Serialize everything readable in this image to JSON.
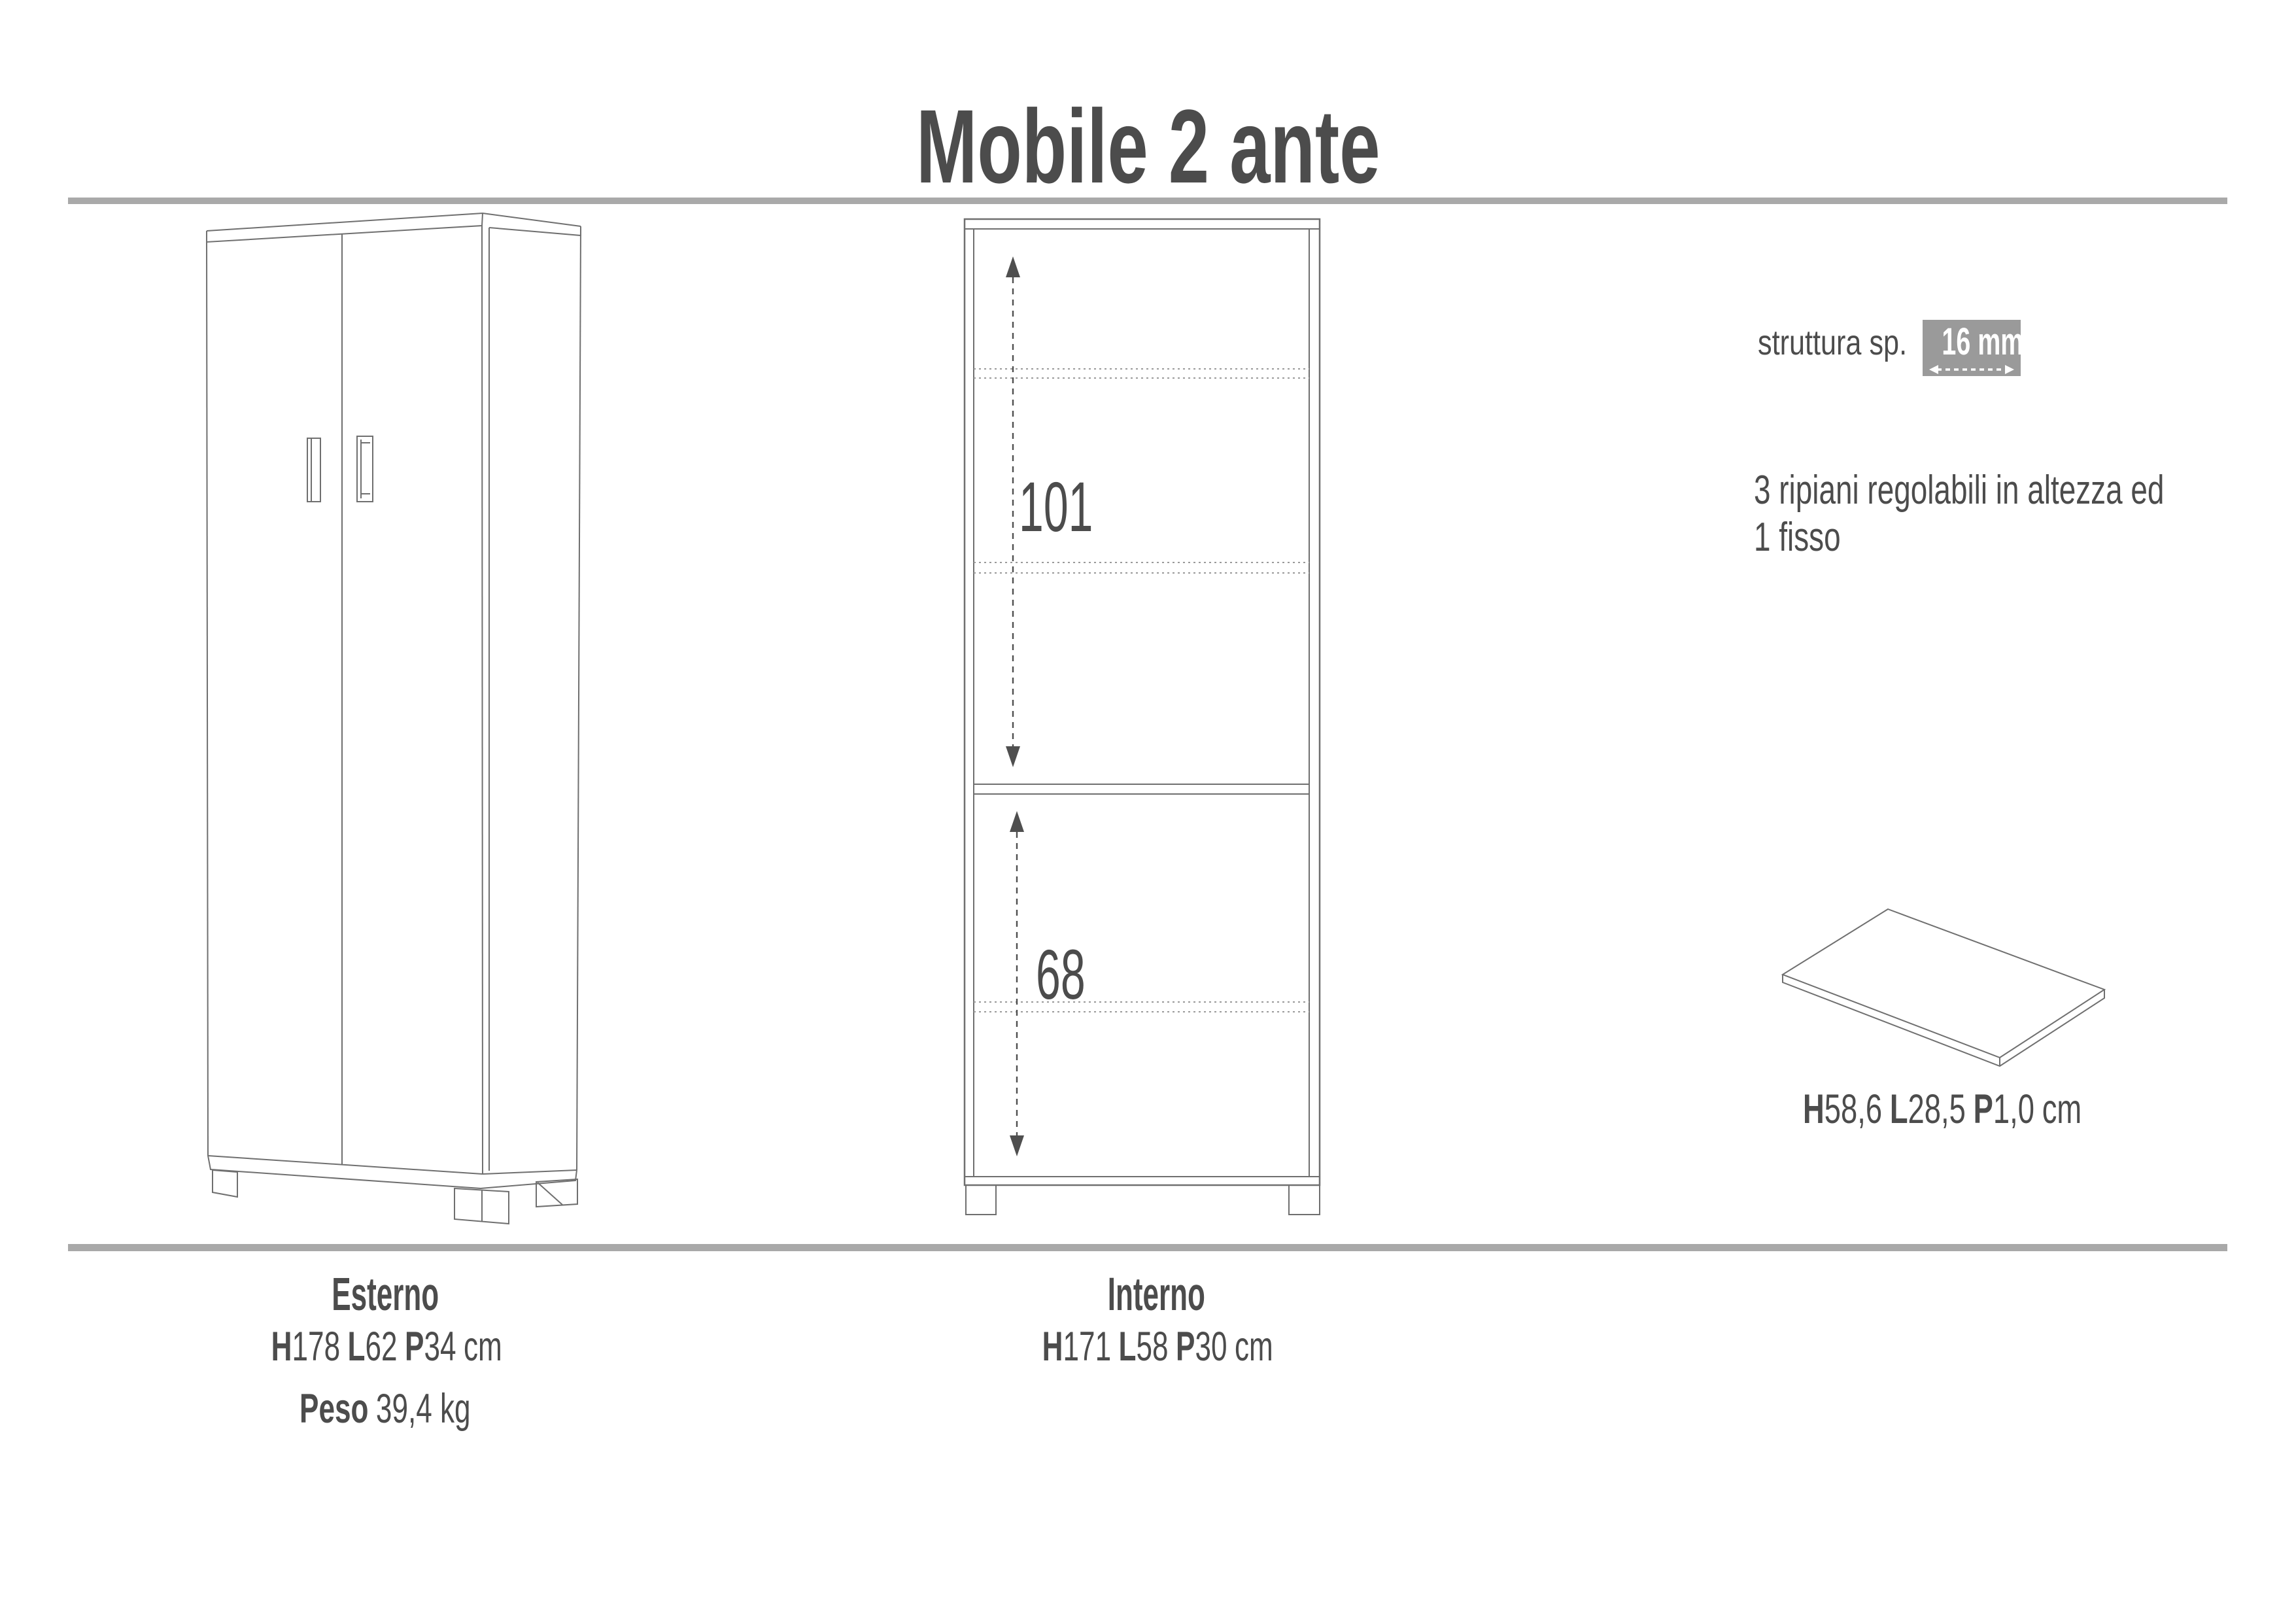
{
  "title": "Mobile 2 ante",
  "interior_view": {
    "upper_dim_cm": "101",
    "lower_dim_cm": "68"
  },
  "specs": {
    "structure_label": "struttura sp.",
    "structure_thickness": "16 mm",
    "shelves_note_line1": "3 ripiani regolabili in altezza ed",
    "shelves_note_line2": "1 fisso",
    "shelf_panel_dims": {
      "h_key": "H",
      "h_value": "58,6",
      "l_key": "L",
      "l_value": "28,5",
      "p_key": "P",
      "p_value": "1,0",
      "unit": "cm"
    }
  },
  "footer": {
    "exterior": {
      "label": "Esterno",
      "h_key": "H",
      "h_value": "178",
      "l_key": "L",
      "l_value": "62",
      "p_key": "P",
      "p_value": "34",
      "unit": "cm",
      "weight_label": "Peso",
      "weight_value": "39,4 kg"
    },
    "interior": {
      "label": "Interno",
      "h_key": "H",
      "h_value": "171",
      "l_key": "L",
      "l_value": "58",
      "p_key": "P",
      "p_value": "30",
      "unit": "cm"
    }
  },
  "colors": {
    "text": "#4c4c4c",
    "rule": "#a9a9a9",
    "highlight_box": "#9a9a9a",
    "line": "#6f6f6f",
    "dashed": "#9a9a9a",
    "arrow": "#4f4f4f"
  }
}
